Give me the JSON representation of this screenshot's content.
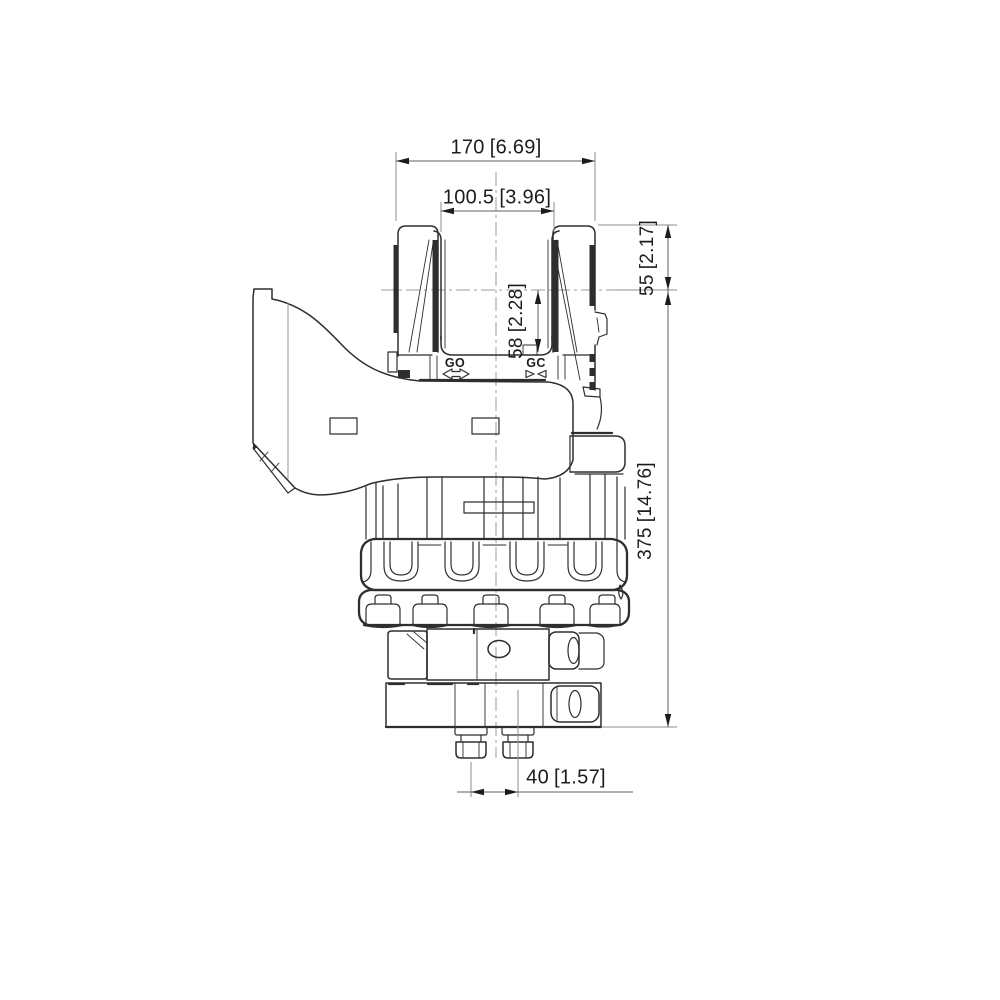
{
  "drawing": {
    "dimensions": {
      "overall_width": {
        "value_mm": "170",
        "value_in": "[6.69]"
      },
      "inner_width": {
        "value_mm": "100.5",
        "value_in": "[3.96]"
      },
      "top_height": {
        "value_mm": "55",
        "value_in": "[2.17]"
      },
      "slot_depth": {
        "value_mm": "58",
        "value_in": "[2.28]"
      },
      "overall_height": {
        "value_mm": "375",
        "value_in": "[14.76]"
      },
      "stud_spacing": {
        "value_mm": "40",
        "value_in": "[1.57]"
      }
    },
    "port_labels": {
      "grapple_open": "GO",
      "grapple_close": "GC"
    },
    "colors": {
      "line": "#2e2e2e",
      "dim_line": "#5f5f5f",
      "extension_line": "#8c8c8c",
      "center_line": "#9b9b9b",
      "text": "#1c1c1c",
      "background": "#ffffff"
    }
  }
}
